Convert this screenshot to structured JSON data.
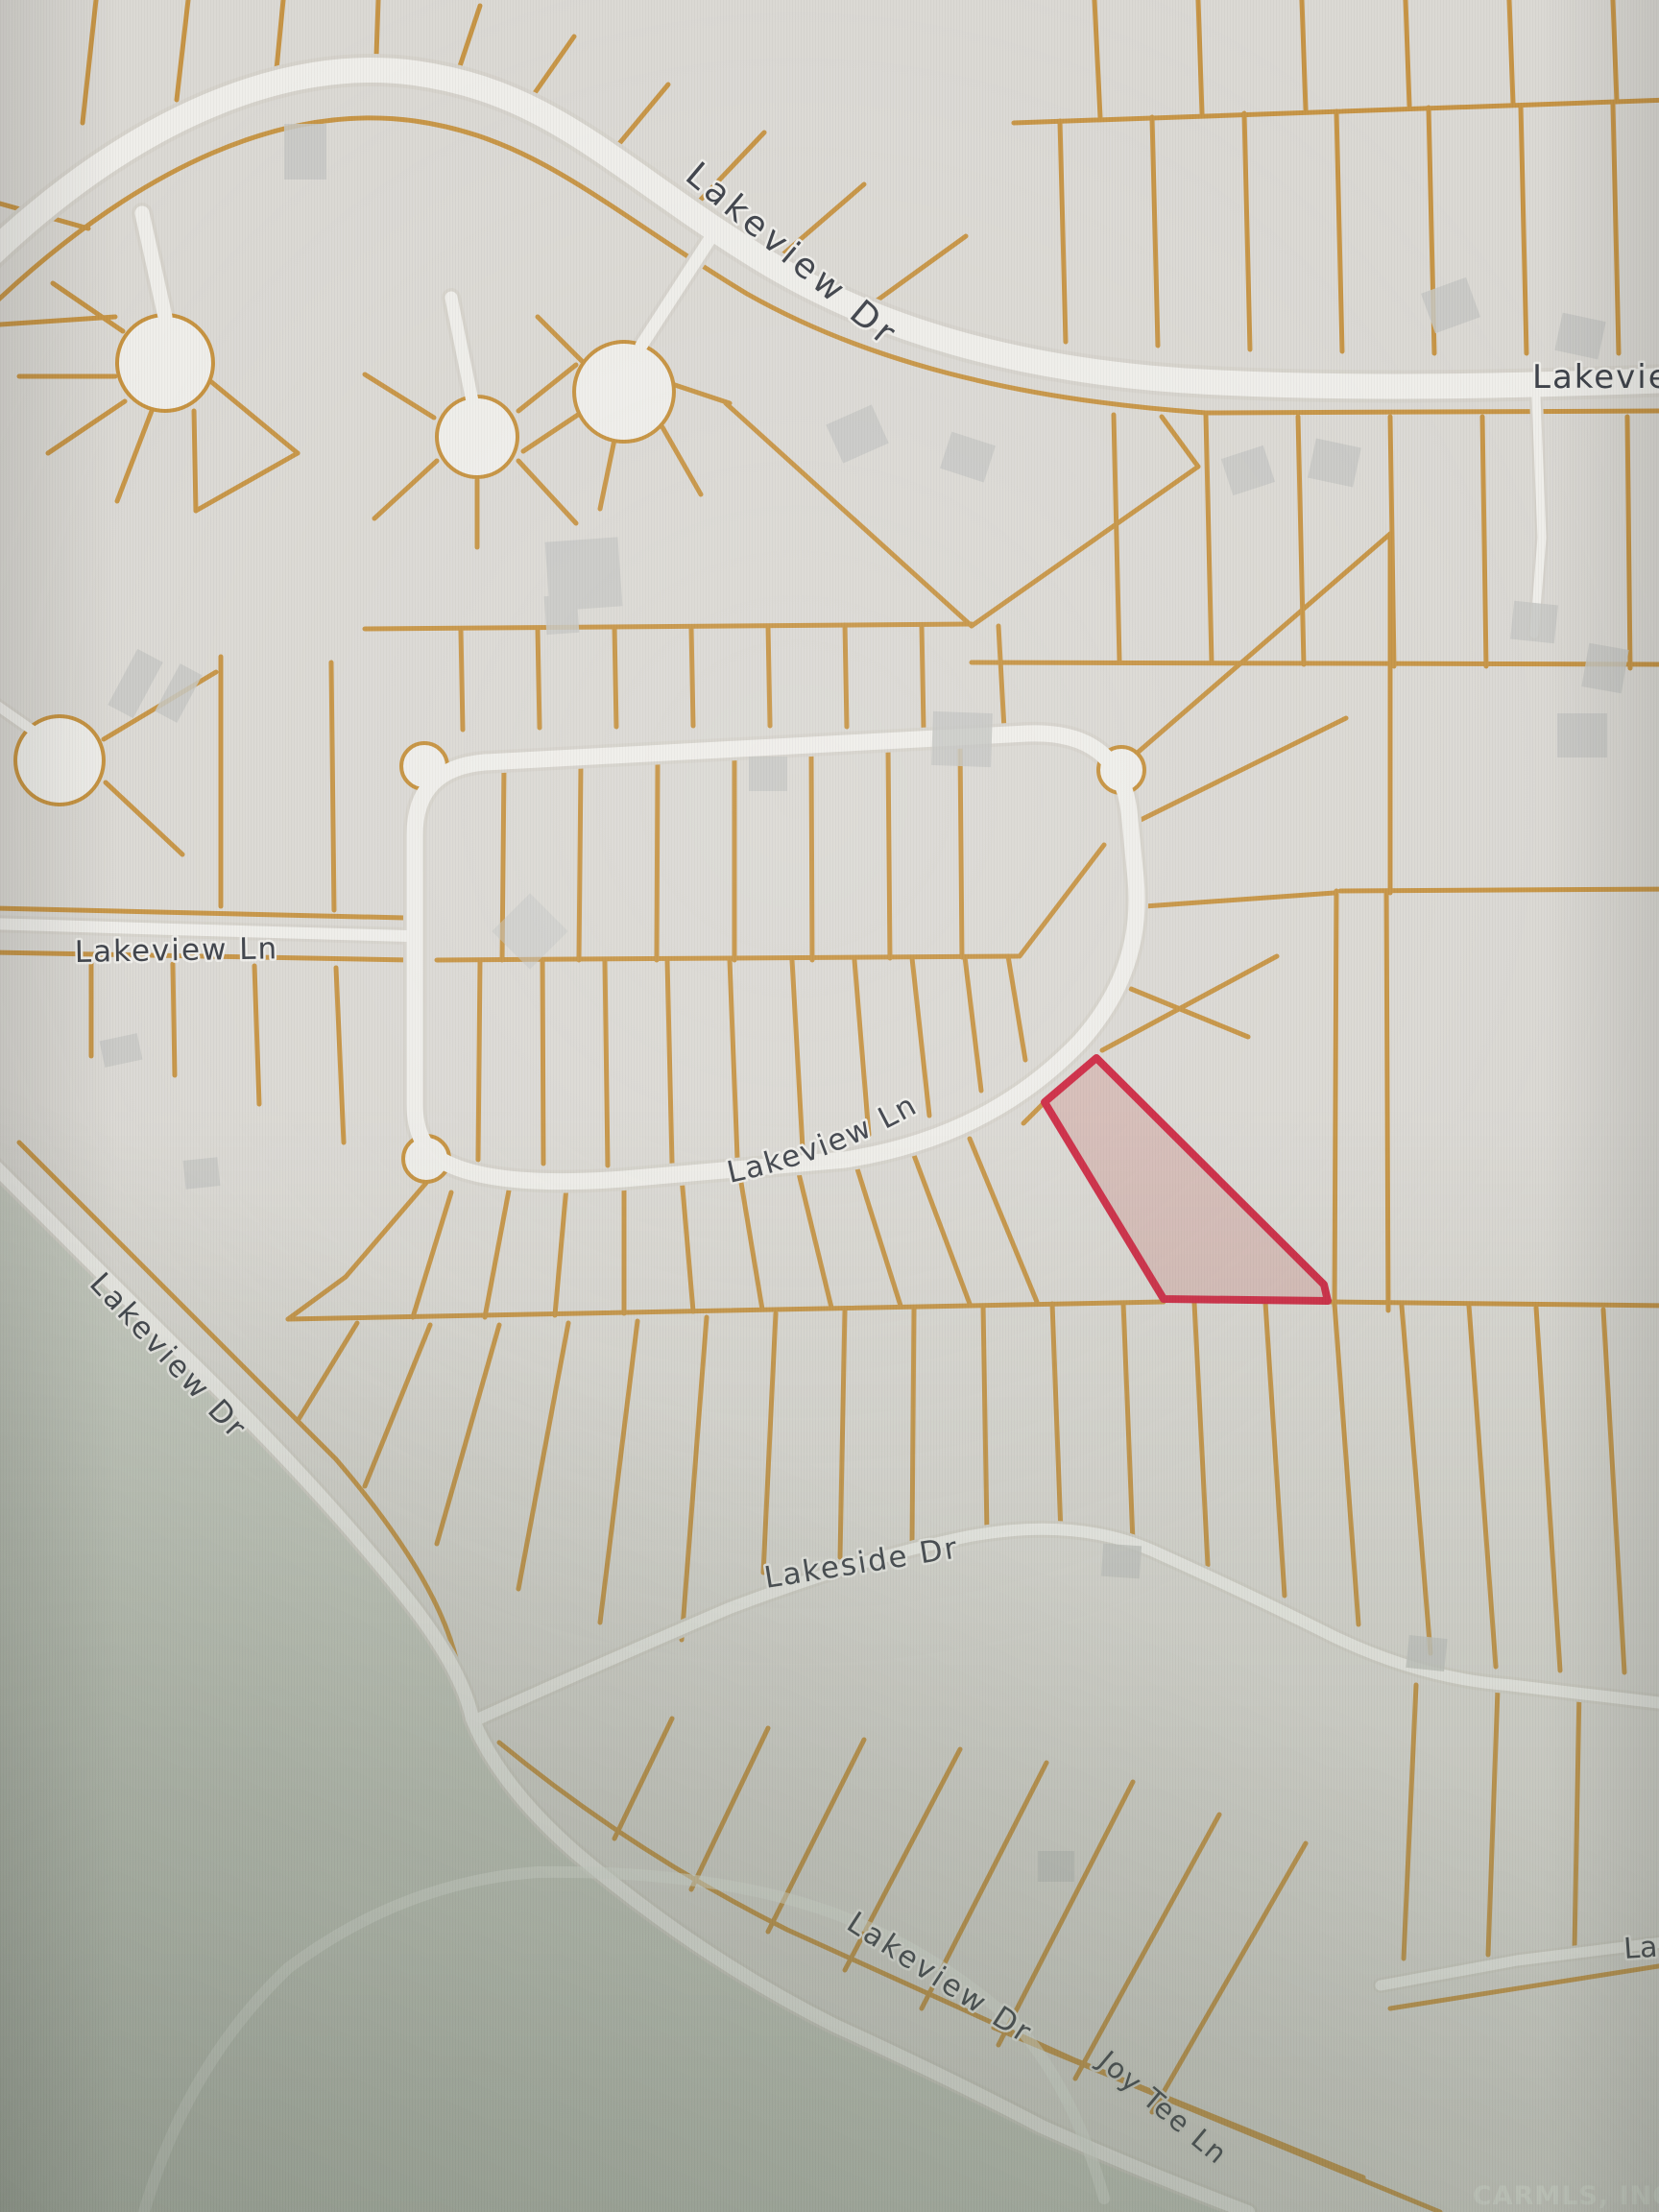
{
  "map": {
    "kind": "residential parcel plat map",
    "labels": {
      "lakeview_dr_north": "Lakeview Dr",
      "lakeview_partial_northeast": "Lakevie",
      "lakeview_ln_west": "Lakeview Ln",
      "lakeview_ln_loop": "Lakeview Ln",
      "lakeview_dr_west": "Lakeview Dr",
      "lakeside_dr": "Lakeside Dr",
      "lakeview_dr_south": "Lakeview Dr",
      "joy_tee_ln": "Joy Tee Ln",
      "lakeview_partial_southeast": "La",
      "watermark": "CARMLS, INC"
    },
    "colors": {
      "background": "#dbd9d4",
      "open_land": "#c6cabf",
      "parcel_line": "#c6923f",
      "road_fill": "#efeeea",
      "road_casing": "#d6d3cc",
      "building_fill": "#c7c8c4",
      "label_text": "#3e424a",
      "highlight_stroke": "#ce2b45",
      "highlight_fill": "rgba(203,125,120,0.30)"
    },
    "highlighted_parcel": {
      "description": "Red-outlined vacant lot on the south side of the Lakeview Ln loop"
    }
  }
}
